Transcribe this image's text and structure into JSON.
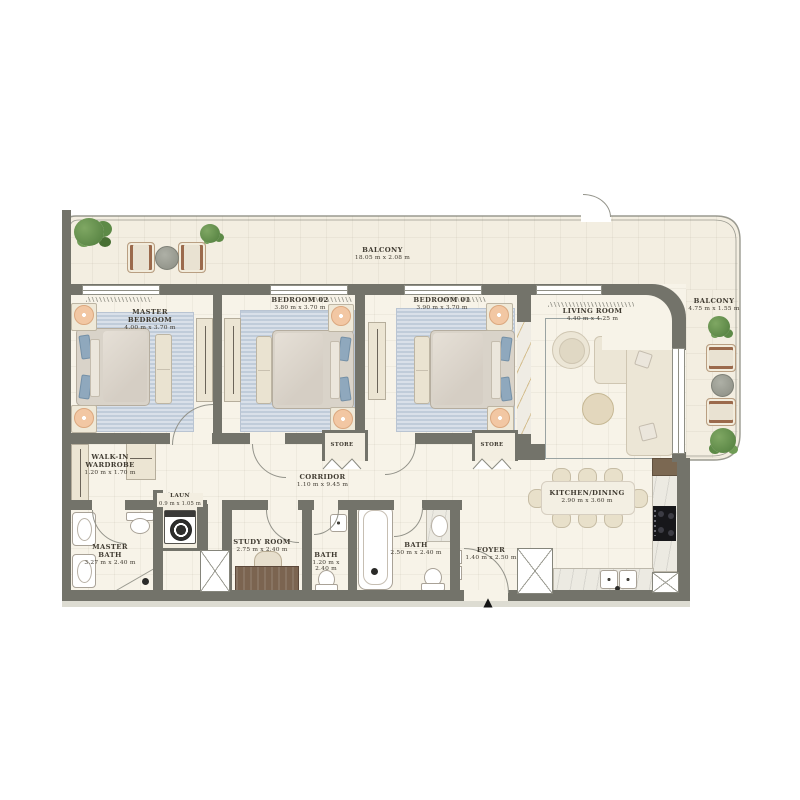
{
  "plan": {
    "title": "Apartment floor plan",
    "entry_marker": "▲"
  },
  "colors": {
    "wall": "#73736a",
    "floor": "#f7f3e8",
    "balcony_floor": "#f3eee1",
    "rug_blue": "#ccd6e2",
    "accent_peach": "#f2c7a3",
    "plant_green": "#5f8d4e",
    "wood": "#7b6852",
    "marble_vein_gold": "#ba923e",
    "label_text": "#3f3a30"
  },
  "rooms": {
    "balcony_top": {
      "name": "BALCONY",
      "dims": "18.05 m x 2.08 m"
    },
    "balcony_right": {
      "name": "BALCONY",
      "dims": "4.75 m x 1.55 m"
    },
    "master_bedroom": {
      "name": "MASTER\nBEDROOM",
      "dims": "4.00 m x 3.70 m"
    },
    "bedroom_02": {
      "name": "BEDROOM 02",
      "dims": "3.80 m x 3.70 m"
    },
    "bedroom_01": {
      "name": "BEDROOM 01",
      "dims": "3.90 m x 3.70 m"
    },
    "living_room": {
      "name": "LIVING ROOM",
      "dims": "4.40 m x 4.25 m"
    },
    "walk_in_wardrobe": {
      "name": "WALK-IN\nWARDROBE",
      "dims": "1.20 m x 1.70 m"
    },
    "corridor": {
      "name": "CORRIDOR",
      "dims": "1.10 m x 9.45 m"
    },
    "laundry": {
      "name": "LAUN",
      "dims": "0.9 m x 1.05 m"
    },
    "master_bath": {
      "name": "MASTER\nBATH",
      "dims": "3.27 m x 2.40 m"
    },
    "study_room": {
      "name": "STUDY ROOM",
      "dims": "2.75 m x 2.40 m"
    },
    "bath_small": {
      "name": "BATH",
      "dims": "1.20 m x 2.40 m"
    },
    "bath_main": {
      "name": "BATH",
      "dims": "2.50 m x 2.40 m"
    },
    "kitchen_dining": {
      "name": "KITCHEN/DINING",
      "dims": "2.90 m x 3.60 m"
    },
    "foyer": {
      "name": "FOYER",
      "dims": "1.40 m x 2.50 m"
    },
    "store_1": {
      "name": "STORE"
    },
    "store_2": {
      "name": "STORE"
    }
  }
}
